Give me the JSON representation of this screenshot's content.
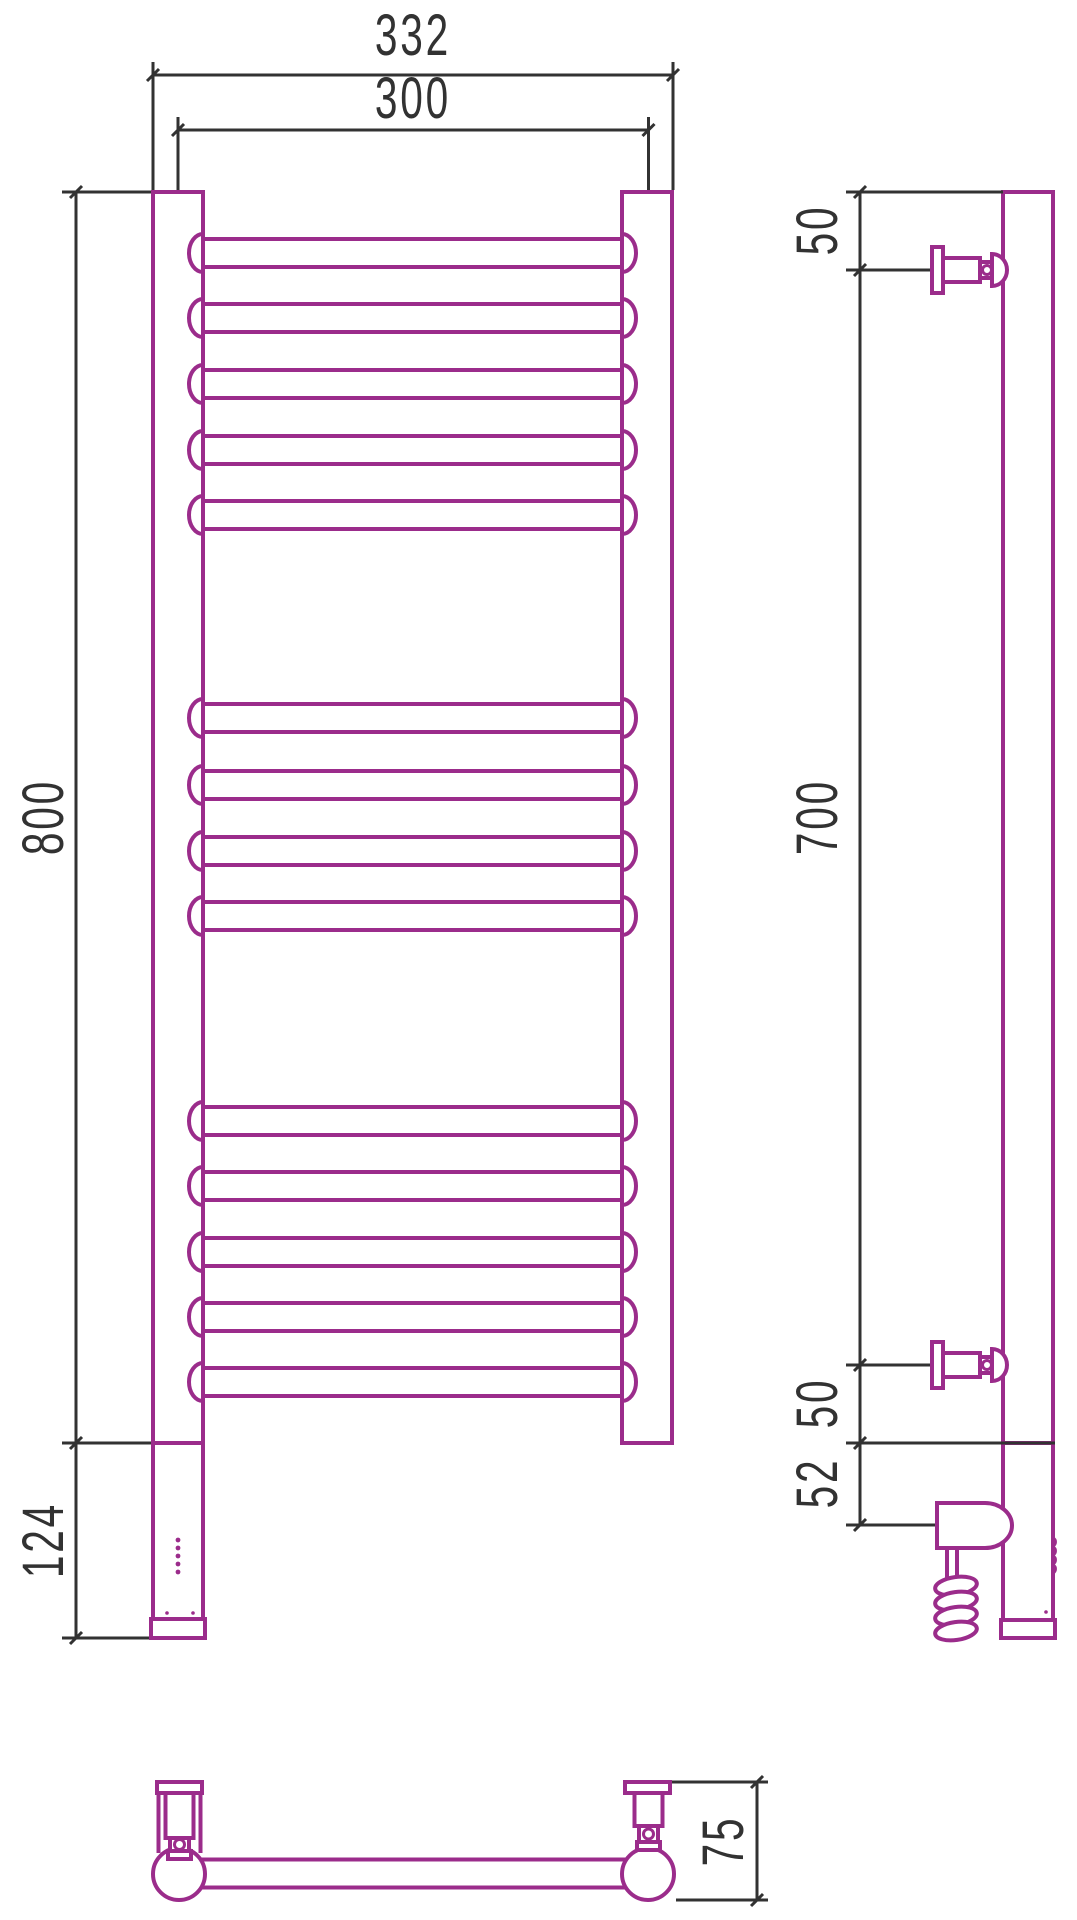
{
  "drawing": {
    "title": "Heated towel rail - dimensional drawing",
    "unit": "mm",
    "colors": {
      "product_outline": "#9B2C8B",
      "dimension_lines": "#323232",
      "background": "#FFFFFF"
    },
    "front_view": {
      "rung_count": 14,
      "rung_groups": [
        5,
        4,
        5
      ],
      "dims": {
        "overall_width": "332",
        "axis_width": "300",
        "height": "800",
        "heater_section_height": "124"
      }
    },
    "side_view": {
      "dims": {
        "top_bracket_offset": "50",
        "bracket_spacing": "700",
        "bottom_bracket_offset": "50",
        "heater_axis_offset": "52"
      }
    },
    "bottom_view": {
      "dims": {
        "wall_depth": "75"
      }
    }
  }
}
